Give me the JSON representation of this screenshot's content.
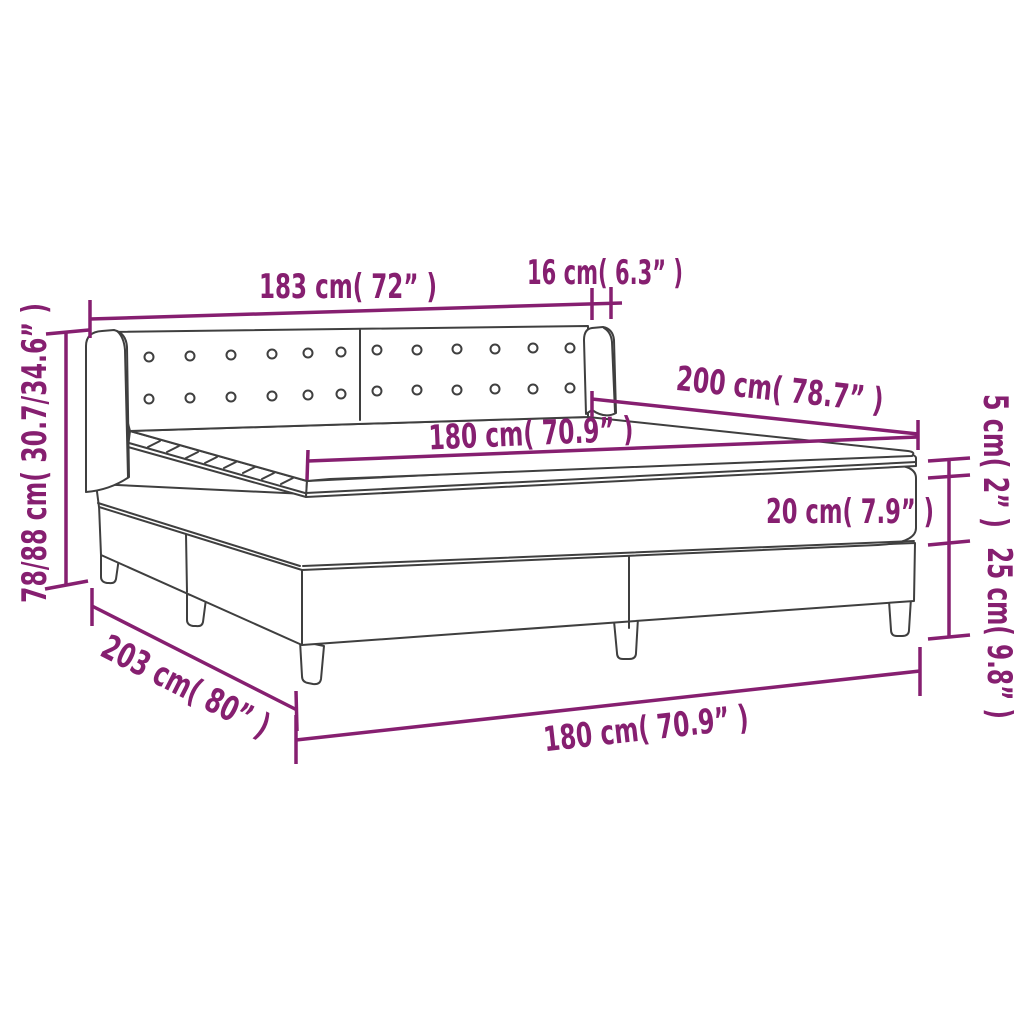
{
  "diagram": {
    "subject": "box-spring-bed-with-upholstered-headboard",
    "background_color": "#ffffff",
    "annotation_color": "#861f70",
    "line_art_color": "#3f3f3f",
    "labels": {
      "headboard_width": "183 cm( 72” )",
      "headboard_wing_depth": "16 cm( 6.3” )",
      "bed_length": "200 cm( 78.7” )",
      "mattress_width": "180 cm( 70.9” )",
      "topper_thickness": "5 cm( 2” )",
      "mattress_thickness": "20 cm( 7.9” )",
      "base_height": "25 cm( 9.8” )",
      "overall_height": "78/88 cm( 30.7/34.6” )",
      "overall_length": "203 cm( 80” )",
      "base_width": "180 cm( 70.9” )"
    }
  }
}
